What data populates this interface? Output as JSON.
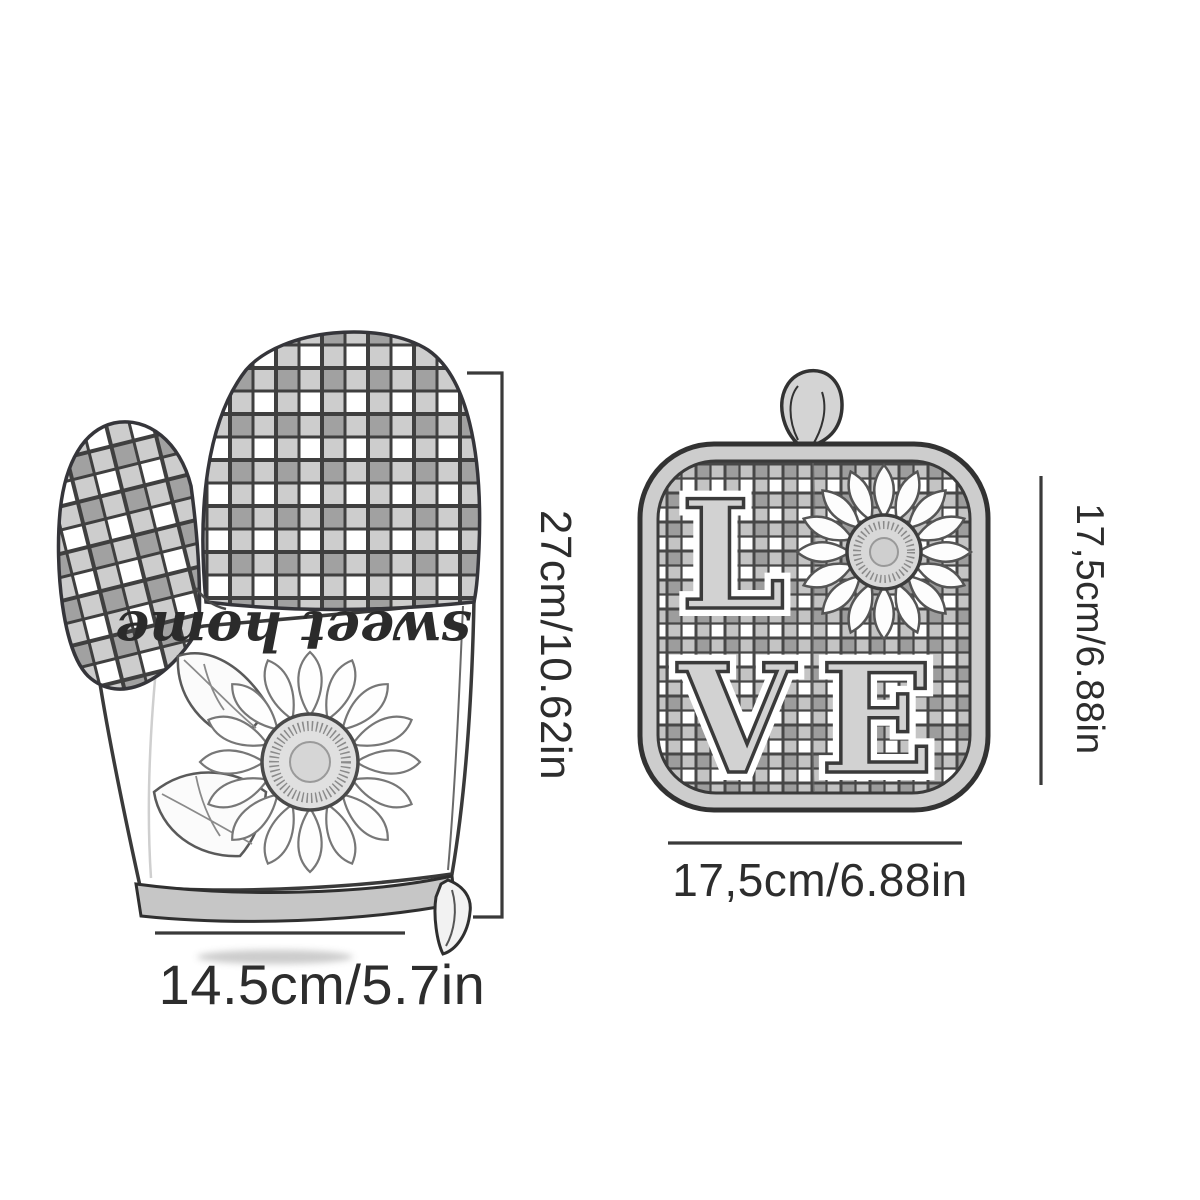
{
  "illustration": {
    "background_color": "#ffffff",
    "sketch_line_color": "#3a3a3a",
    "label_text_color": "#2d2d2d",
    "check_fill_color": "#b9b9b9"
  },
  "oven_mitt": {
    "item": "oven mitt",
    "pattern": "gingham check",
    "print_text": "sweet home",
    "motif": "sunflower with leaves",
    "height_label": "27cm/10.62in",
    "width_label": "14.5cm/5.7in"
  },
  "pot_holder": {
    "item": "pot holder",
    "pattern": "gingham check",
    "word": "LOVE",
    "letter_l": "L",
    "letter_v": "V",
    "letter_e": "E",
    "motif": "sunflower as letter O",
    "height_label": "17,5cm/6.88in",
    "width_label": "17,5cm/6.88in"
  }
}
